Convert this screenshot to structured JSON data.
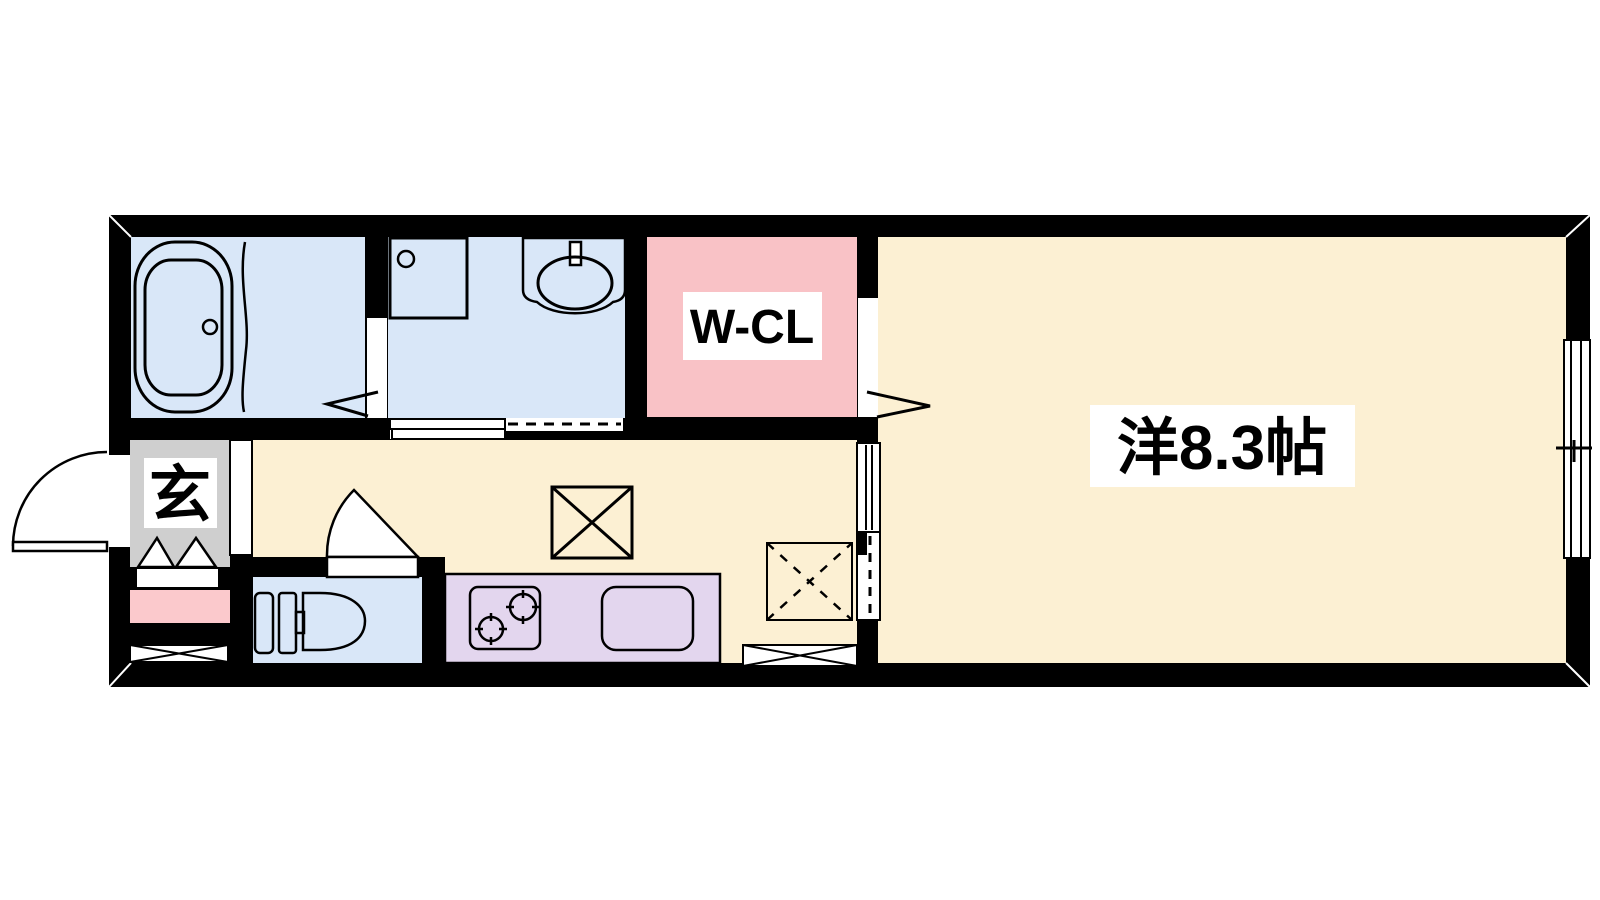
{
  "labels": {
    "main_room": "洋8.3帖",
    "walk_in_closet": "W-CL",
    "entrance": "玄"
  },
  "colors": {
    "background": "#FFFFFF",
    "wall": "#000000",
    "wet_area_blue": "#D9E7F8",
    "living_cream": "#FCF0D3",
    "closet_pink": "#F9C2C6",
    "kitchen_purple": "#E3D6EE",
    "entrance_gray": "#CFCFCF",
    "accent_pink_strip": "#FBC9CC",
    "label_background": "#FFFFFF",
    "line_black": "#000000"
  }
}
